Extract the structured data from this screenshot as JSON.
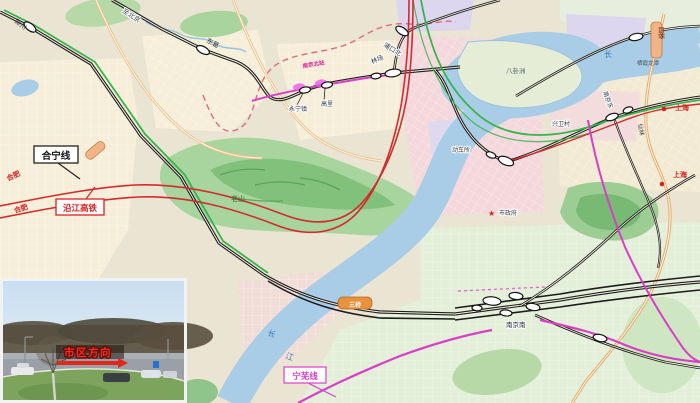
{
  "map": {
    "callouts": {
      "hening": {
        "label": "合宁线"
      },
      "yanjiang": {
        "label": "沿江高铁"
      },
      "ningwu": {
        "label": "宁芜线"
      }
    },
    "colors": {
      "railway_black": "#1c1c1c",
      "highspeed_red": "#d42a2a",
      "green_line": "#35b54a",
      "magenta_line": "#d93ec8",
      "river_blue": "#a9cde6",
      "road_orange": "#efc089",
      "boundary_pink": "#e2697e",
      "hill_green": "#a8d49e"
    },
    "labels": [
      {
        "n": "label-chuzhou",
        "t": "滁州",
        "x": 14,
        "y": 22,
        "r": 38,
        "s": 6.5,
        "c": "#333a44"
      },
      {
        "n": "label-to-beijing",
        "t": "至北京",
        "x": 122,
        "y": 12,
        "r": 33,
        "s": 6.5,
        "c": "#333a44",
        "h": true
      },
      {
        "n": "label-dongge",
        "t": "东葛",
        "x": 206,
        "y": 42,
        "r": 28,
        "s": 6.5,
        "c": "#333a44"
      },
      {
        "n": "label-pukoubei",
        "t": "浦口北",
        "x": 383,
        "y": 46,
        "r": 32,
        "s": 6.5,
        "c": "#333a44",
        "h": true
      },
      {
        "n": "label-linchang",
        "t": "林场",
        "x": 372,
        "y": 64,
        "r": -22,
        "s": 6.5,
        "c": "#333a44",
        "h": true
      },
      {
        "n": "label-yongningzhen",
        "t": "永宁镇",
        "x": 289,
        "y": 111,
        "s": 6,
        "c": "#333a44",
        "h": true
      },
      {
        "n": "label-gaoli",
        "t": "高里",
        "x": 321,
        "y": 106,
        "s": 6,
        "c": "#333a44",
        "h": true
      },
      {
        "n": "label-nanjingbei",
        "t": "南京北站",
        "x": 303,
        "y": 68,
        "r": -10,
        "s": 5.5,
        "c": "#e0189a",
        "b": true
      },
      {
        "n": "label-baguazhou",
        "t": "八卦洲",
        "x": 506,
        "y": 73,
        "s": 6.5,
        "c": "#5b6878"
      },
      {
        "n": "label-dongchesuo",
        "t": "动车所",
        "x": 452,
        "y": 152,
        "s": 6,
        "c": "#333a44",
        "h": true
      },
      {
        "n": "label-xingweicun",
        "t": "兴卫村",
        "x": 552,
        "y": 126,
        "s": 6,
        "c": "#333a44",
        "h": true
      },
      {
        "n": "label-nanjingdong",
        "t": "南京东",
        "x": 603,
        "y": 92,
        "r": 70,
        "s": 6,
        "c": "#333a44",
        "h": true
      },
      {
        "n": "label-xianlin",
        "t": "仙林",
        "x": 638,
        "y": 124,
        "r": 80,
        "s": 6,
        "c": "#333a44"
      },
      {
        "n": "label-qixialongtan",
        "t": "栖霞龙潭",
        "x": 637,
        "y": 65,
        "s": 5.5,
        "c": "#46505c"
      },
      {
        "n": "label-changjiang-ne",
        "t": "长",
        "x": 604,
        "y": 57,
        "s": 8,
        "c": "#3a7fb5"
      },
      {
        "n": "label-chang",
        "t": "长",
        "x": 267,
        "y": 335,
        "r": 20,
        "s": 8,
        "c": "#3a7fb5"
      },
      {
        "n": "label-jiang",
        "t": "江",
        "x": 285,
        "y": 358,
        "r": 20,
        "s": 8,
        "c": "#3a7fb5"
      },
      {
        "n": "label-hefei-1",
        "t": "合肥",
        "x": 8,
        "y": 181,
        "r": -25,
        "s": 7,
        "c": "#d62222",
        "b": true
      },
      {
        "n": "label-hefei-2",
        "t": "合肥",
        "x": 15,
        "y": 213,
        "r": -18,
        "s": 7,
        "c": "#d62222",
        "b": true
      },
      {
        "n": "label-shanghai-1",
        "t": "上海",
        "x": 675,
        "y": 110,
        "s": 7,
        "c": "#d62222",
        "b": true
      },
      {
        "n": "label-shanghai-2",
        "t": "上海",
        "x": 673,
        "y": 177,
        "s": 7,
        "c": "#d62222",
        "b": true
      },
      {
        "n": "label-city-hall-star",
        "t": "★",
        "x": 488,
        "y": 216,
        "s": 8,
        "c": "#e02020"
      },
      {
        "n": "label-city-hall",
        "t": "市政府",
        "x": 499,
        "y": 215,
        "s": 6,
        "c": "#333a44",
        "h": true
      },
      {
        "n": "label-nanjingnan",
        "t": "南京南",
        "x": 506,
        "y": 327,
        "s": 6.5,
        "c": "#222833",
        "h": true
      },
      {
        "n": "label-laoshan",
        "t": "老山",
        "x": 231,
        "y": 201,
        "s": 7,
        "c": "#2f6b36"
      },
      {
        "n": "label-sanqiao",
        "t": "三桥",
        "x": 355,
        "y": 307,
        "s": 6,
        "c": "#ffffff",
        "b": true,
        "a": "middle"
      },
      {
        "n": "label-siqiao",
        "t": "四桥",
        "x": 659,
        "y": 27,
        "r": 90,
        "s": 6,
        "c": "#8a4a20",
        "b": true
      },
      {
        "n": "inset-sign-text",
        "t": "市区方向",
        "x": 88,
        "y": 356,
        "s": 10.5,
        "c": "#ff2a18",
        "b": true,
        "cls": "sign",
        "a": "middle"
      }
    ]
  },
  "inset": {
    "sign_text": "市区方向"
  }
}
